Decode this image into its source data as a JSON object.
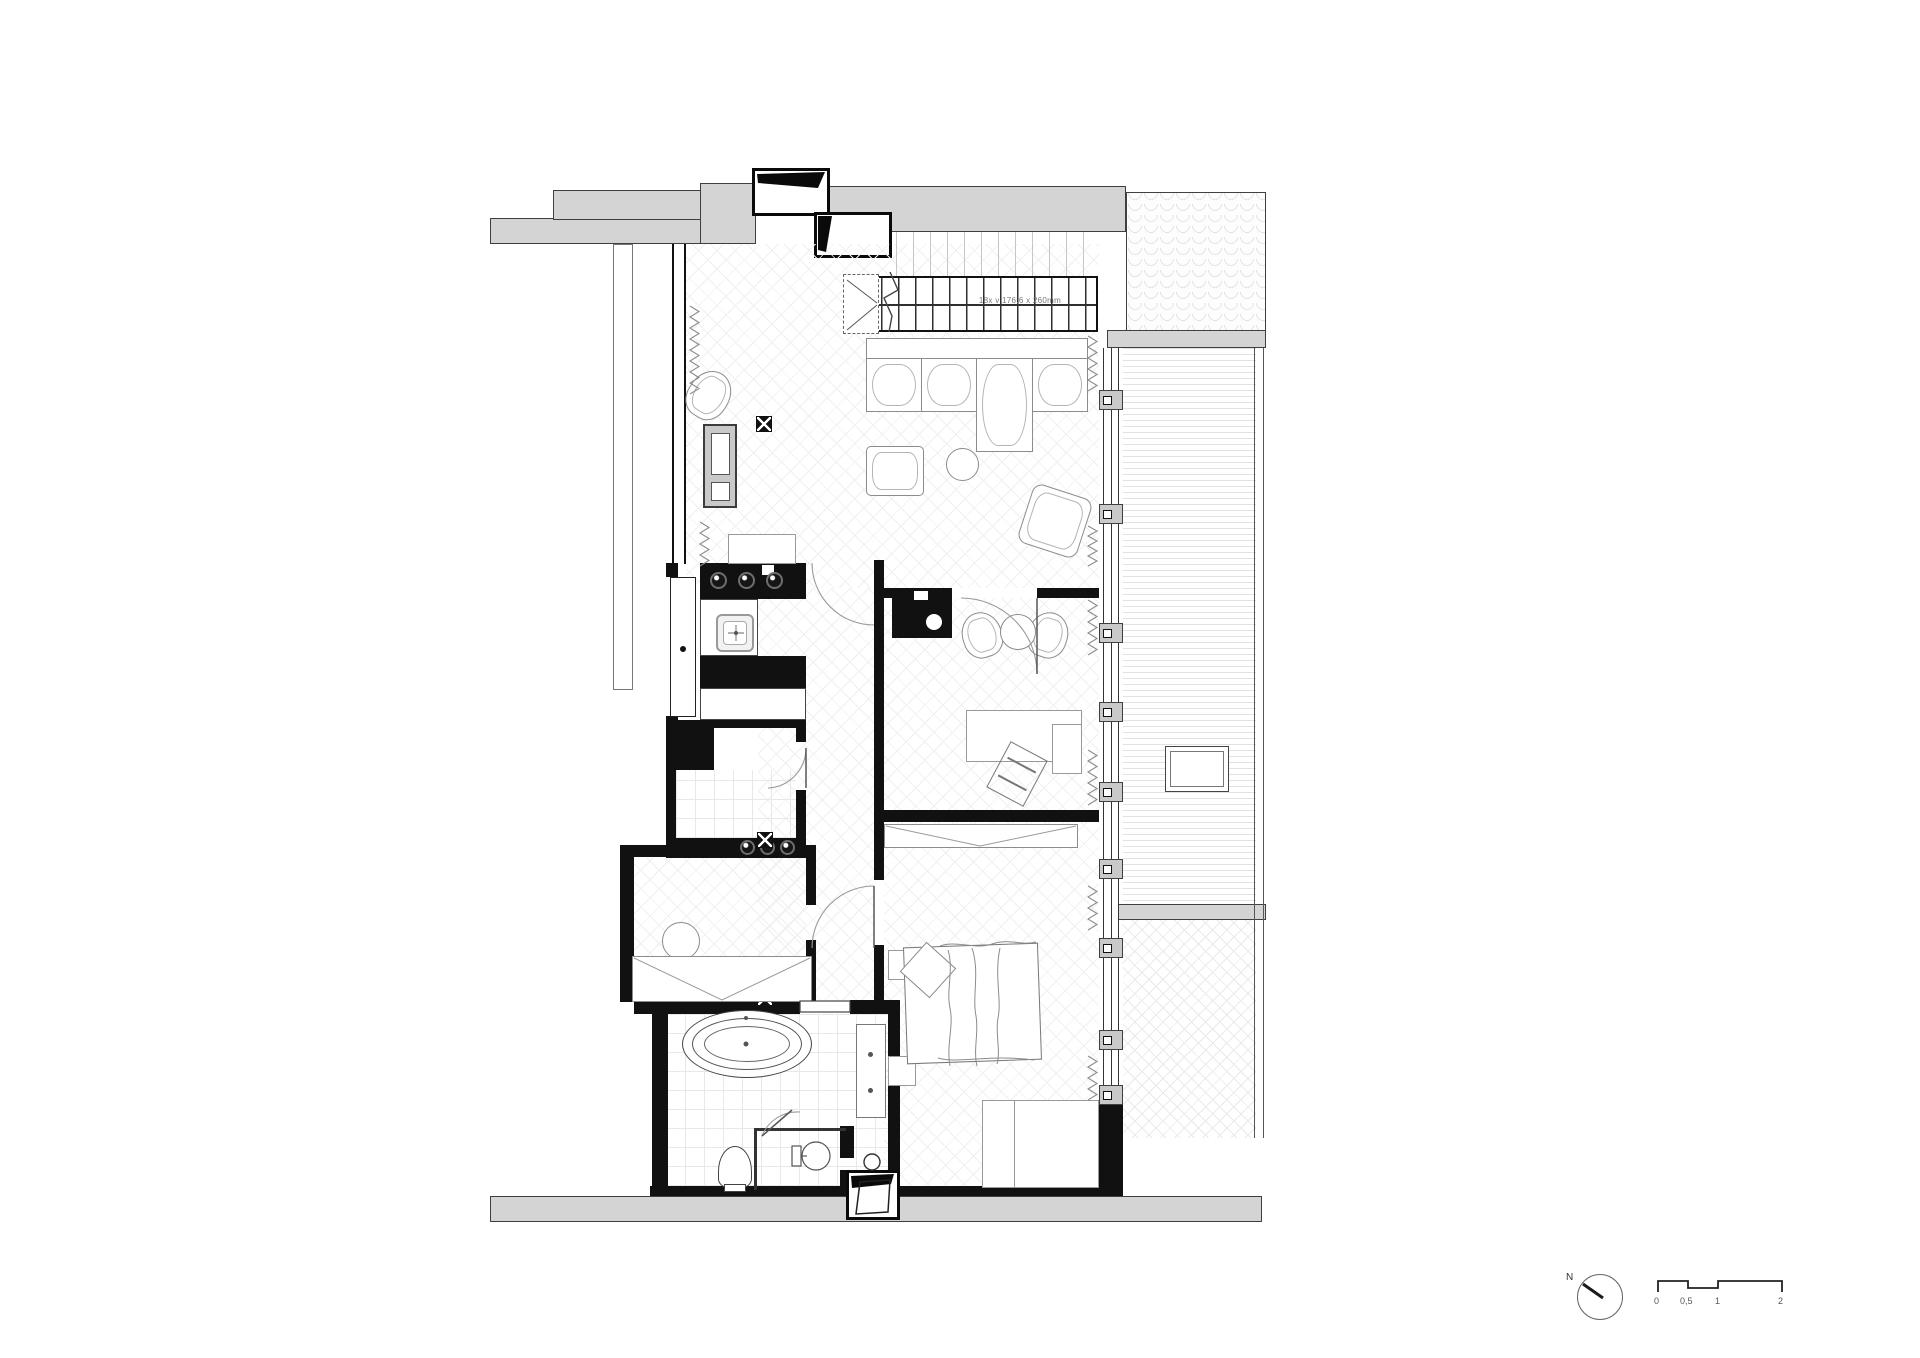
{
  "drawing": {
    "stairs_label": "18x v 176,6 x 260mm",
    "north_label": "N",
    "scale_ticks": [
      "0",
      "0,5",
      "1",
      "2"
    ],
    "colors": {
      "existing_wall_fill": "#d4d4d4",
      "existing_wall_line": "#3f3f3f",
      "new_wall_fill": "#111111",
      "furniture_line": "#8c8c8c",
      "floor_pattern_line": "#f0f0f0",
      "background": "#ffffff"
    },
    "icons": {
      "north_arrow": "circle-with-needle",
      "ceiling_light": "crossed-box",
      "cooktop_burners": 3,
      "laundry_knobs": 3
    }
  }
}
